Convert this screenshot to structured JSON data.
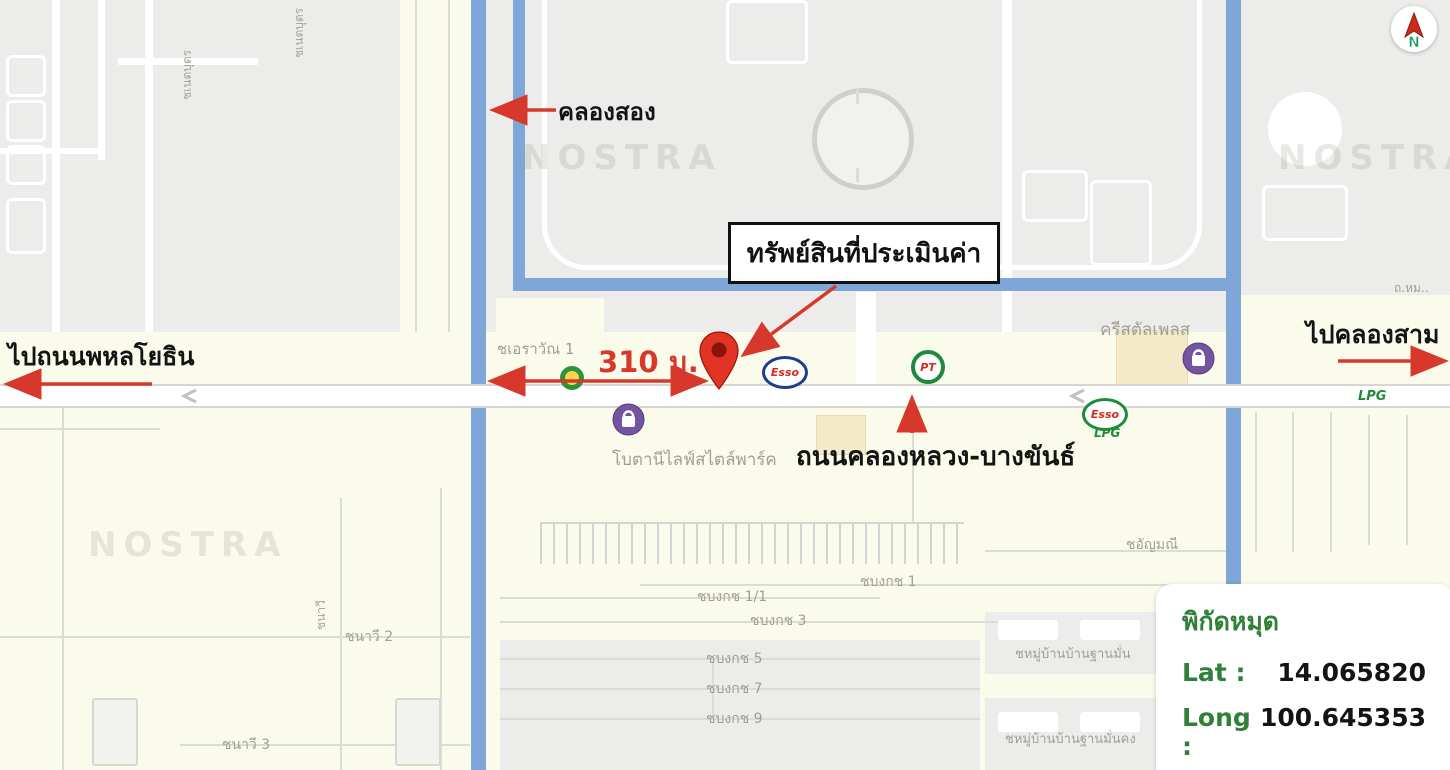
{
  "annotations": {
    "canal": "คลองสอง",
    "property": "ทรัพย์สินที่ประเมินค่า",
    "distance": "310 ม.",
    "to_phahonyothin": "ไปถนนพหลโยธิน",
    "to_khlong_sam": "ไปคลองสาม",
    "main_road": "ถนนคลองหลวง-บางขันธ์"
  },
  "coordinates_card": {
    "title": "พิกัดหมุด",
    "lat_label": "Lat :",
    "lat_value": "14.065820",
    "long_label": "Long :",
    "long_value": "100.645353"
  },
  "compass": {
    "north": "N"
  },
  "watermark": "NOSTRA",
  "poi": {
    "esso": "Esso",
    "esso_lpg": "Esso",
    "esso_lpg_sub": "LPG",
    "pt": "PT"
  },
  "place_labels": [
    {
      "text": "ชเอราวัณ 1"
    },
    {
      "text": "ครีสตัลเพลส"
    },
    {
      "text": "โบตานีไลฟ์สไตล์พาร์ค"
    },
    {
      "text": "ชอัญมณี"
    },
    {
      "text": "ชบงกช 1"
    },
    {
      "text": "ชบงกช 1/1"
    },
    {
      "text": "ชบงกช 3"
    },
    {
      "text": "ชบงกช 5"
    },
    {
      "text": "ชบงกช 7"
    },
    {
      "text": "ชบงกช 9"
    },
    {
      "text": "ชหมู่บ้านบ้านฐานมั่น"
    },
    {
      "text": "ชหมู่บ้านบ้านฐานมั่นคง"
    },
    {
      "text": "ชนาวี 2"
    },
    {
      "text": "ชนาวี 3"
    },
    {
      "text": "ถ.หม.."
    },
    {
      "text": "LPG"
    },
    {
      "text": "ชเนตบุตร"
    },
    {
      "text": "ชเนตบุตร"
    },
    {
      "text": "ชนาวี"
    }
  ],
  "colors": {
    "annotation_red": "#d6392b",
    "coordinate_green": "#2f8038",
    "canal_blue": "#7fa6d8",
    "map_cream": "#fbfbec",
    "map_gray": "#ececea",
    "pin_red": "#e23425"
  }
}
